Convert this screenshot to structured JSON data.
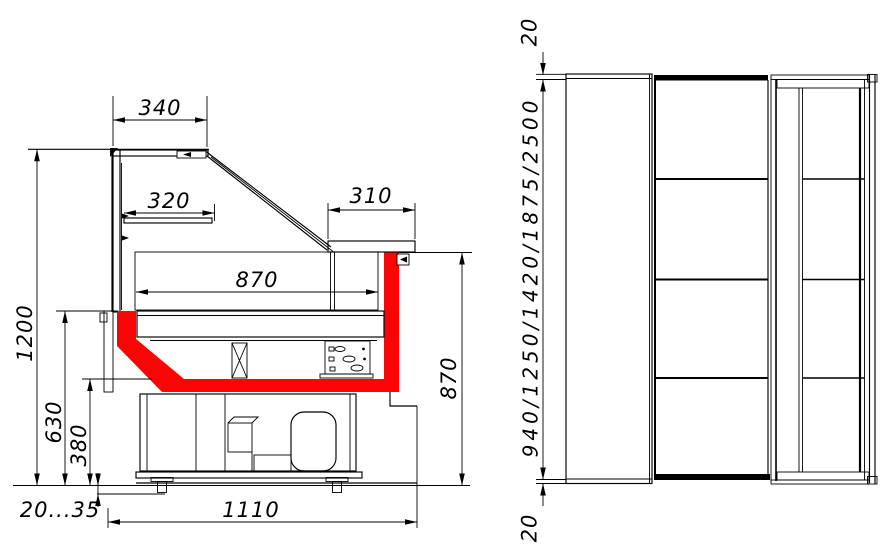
{
  "colors": {
    "glass": "#00ffff",
    "highlight": "#fa0505",
    "line": "#000000",
    "background": "#ffffff"
  },
  "side_view": {
    "canopy_width": "340",
    "shelf_width": "320",
    "counter_depth": "310",
    "deck_width": "870",
    "overall_height": "1200",
    "glass_base_height": "630",
    "basin_base_height": "380",
    "counter_height": "870",
    "foot_height_range": "20...35",
    "base_depth": "1110"
  },
  "plan_view": {
    "top_overhang": "20",
    "lengths": "940/1250/1420/1875/2500",
    "bottom_overhang": "20"
  }
}
